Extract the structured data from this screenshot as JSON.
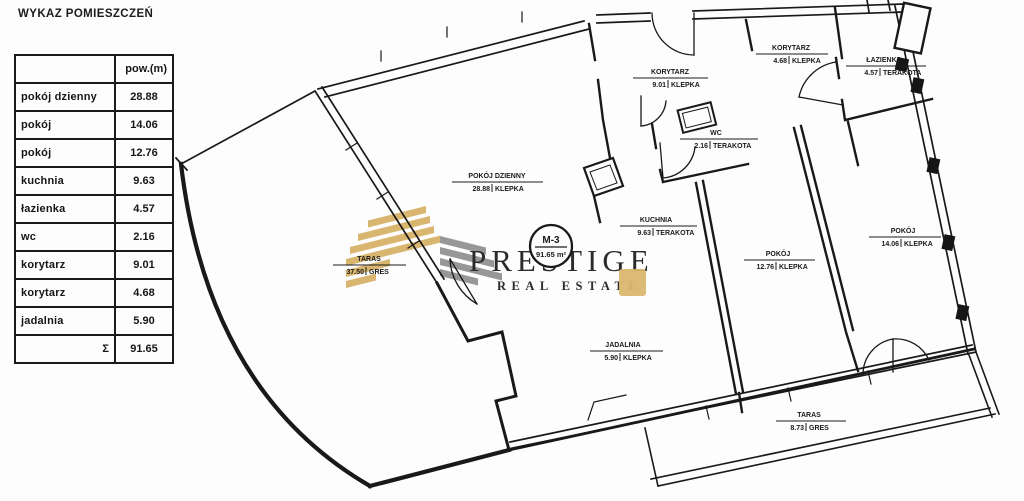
{
  "title": "WYKAZ POMIESZCZEŃ",
  "table": {
    "header_area": "pow.(m)",
    "rows": [
      {
        "name": "pokój dzienny",
        "value": "28.88"
      },
      {
        "name": "pokój",
        "value": "14.06"
      },
      {
        "name": "pokój",
        "value": "12.76"
      },
      {
        "name": "kuchnia",
        "value": "9.63"
      },
      {
        "name": "łazienka",
        "value": "4.57"
      },
      {
        "name": "wc",
        "value": "2.16"
      },
      {
        "name": "korytarz",
        "value": "9.01"
      },
      {
        "name": "korytarz",
        "value": "4.68"
      },
      {
        "name": "jadalnia",
        "value": "5.90"
      }
    ],
    "total_symbol": "Σ",
    "total_value": "91.65"
  },
  "plan": {
    "unit_badge": {
      "code": "M-3",
      "area": "91.65 m²"
    },
    "rooms": [
      {
        "name": "POKÓJ DZIENNY",
        "area": "28.88",
        "material": "KLEPKA"
      },
      {
        "name": "KORYTARZ",
        "area": "9.01",
        "material": "KLEPKA"
      },
      {
        "name": "KORYTARZ",
        "area": "4.68",
        "material": "KLEPKA"
      },
      {
        "name": "ŁAZIENKA",
        "area": "4.57",
        "material": "TERAKOTA"
      },
      {
        "name": "WC",
        "area": "2.16",
        "material": "TERAKOTA"
      },
      {
        "name": "KUCHNIA",
        "area": "9.63",
        "material": "TERAKOTA"
      },
      {
        "name": "POKÓJ",
        "area": "12.76",
        "material": "KLEPKA"
      },
      {
        "name": "POKÓJ",
        "area": "14.06",
        "material": "KLEPKA"
      },
      {
        "name": "JADALNIA",
        "area": "5.90",
        "material": "KLEPKA"
      },
      {
        "name": "TARAS",
        "area": "37.50",
        "material": "GRES"
      },
      {
        "name": "TARAS",
        "area": "8.73",
        "material": "GRES"
      }
    ]
  },
  "watermark": {
    "brand": "PRESTIGE",
    "tagline": "REAL ESTATE",
    "gold": "#d7b163",
    "gray": "#8f8f8f"
  }
}
